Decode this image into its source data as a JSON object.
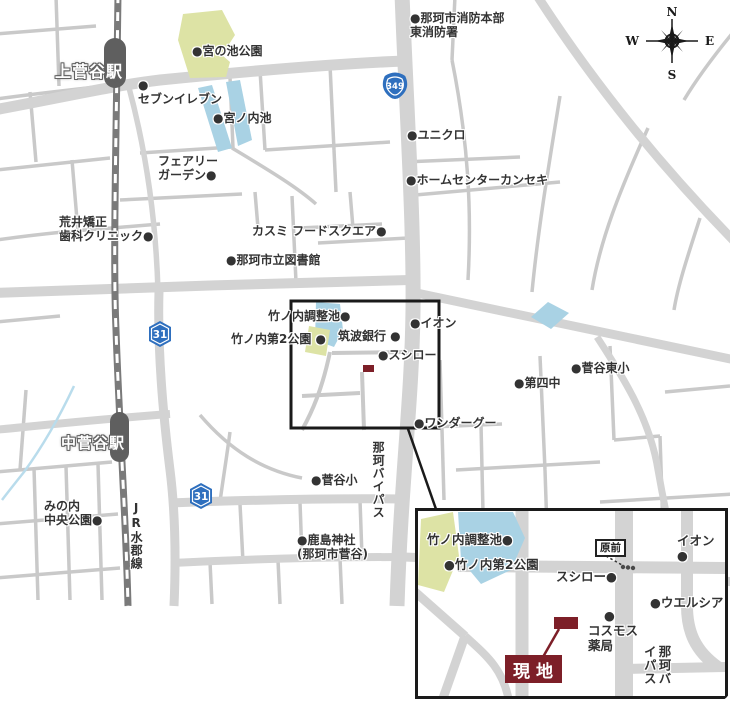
{
  "colors": {
    "road_major": "#d3d3d3",
    "road_minor": "#c9c9c9",
    "railway": "#7a7a7a",
    "station_fill": "#5f5f5f",
    "park_green": "#dde3a5",
    "pond_blue": "#a9d2e4",
    "stream_blue": "#b9dcec",
    "route_sign_blue": "#2e6fbe",
    "accent_maroon": "#7d1f28",
    "ink": "#333333",
    "frame_black": "#1a1a1a"
  },
  "compass": {
    "n": "N",
    "e": "E",
    "s": "S",
    "w": "W"
  },
  "stations": {
    "kamisugaya": "上菅谷駅",
    "nakasugaya": "中菅谷駅"
  },
  "route_shields": {
    "national_349": "349",
    "prefectural_31": "31"
  },
  "line_labels": {
    "jr_suigun": "JR水郡線",
    "naka_bypass": "那珂バイパス"
  },
  "pois": {
    "miyanoike_park": "●宮の池公園",
    "seven_eleven": "●\nセブンイレブン",
    "miyanouchi_pond": "●宮ノ内池",
    "fairy_garden": "フェアリー\nガーデン●",
    "arai_dental": "荒井矯正\n歯科クリニック●",
    "kasumi_food_square": "カスミ フードスクエア●",
    "naka_library": "●那珂市立図書館",
    "fire_station": "●那珂市消防本部\n東消防署",
    "uniqlo": "●ユニクロ",
    "kanseki": "●ホームセンターカンセキ",
    "chosei_pond": "竹ノ内調整池●",
    "dai2_park": "竹ノ内第2公園 ●",
    "tsukuba_bank": "筑波銀行 ●",
    "aeon": "●イオン",
    "sushiro": "●スシロー",
    "wonder_goo": "●ワンダーグー",
    "sugaya_higashi_elem": "●菅谷東小",
    "dai4_junior": "●第四中",
    "sugaya_elem": "●菅谷小",
    "kashima_shrine": "●鹿島神社\n(那珂市菅谷)",
    "minouchi_park": "みの内\n中央公園●"
  },
  "inset": {
    "pois": {
      "chosei_pond": "竹ノ内調整池●",
      "dai2_park": "●竹ノ内第2公園",
      "sushiro": "スシロー●",
      "aeon": "イオン●",
      "welcia": "●ウエルシア",
      "cosmos_pharmacy": "●\nコスモス\n薬局"
    },
    "bus_stop": "原前",
    "site_label": "現地",
    "bypass_label": "那珂バイパス"
  }
}
